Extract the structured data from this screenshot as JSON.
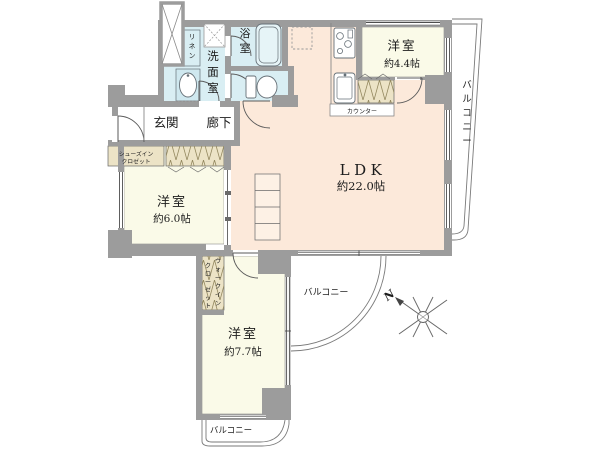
{
  "rooms": {
    "ldk": {
      "name": "LDK",
      "size": "約22.0帖"
    },
    "bedroom_44": {
      "name": "洋室",
      "size": "約4.4帖"
    },
    "bedroom_60": {
      "name": "洋室",
      "size": "約6.0帖"
    },
    "bedroom_77": {
      "name": "洋室",
      "size": "約7.7帖"
    },
    "bath": {
      "name": "浴室"
    },
    "washroom": {
      "name": "洗面室"
    },
    "linen": {
      "name": "リネン"
    },
    "entrance": {
      "name": "玄関"
    },
    "hallway": {
      "name": "廊下"
    },
    "shoes_closet": {
      "line1": "シューズイン",
      "line2": "クロゼット"
    },
    "walk_in_closet": {
      "col_right": "ウォークイン",
      "col_left": "クローゼット"
    },
    "kitchen_counter": {
      "name": "カウンター"
    }
  },
  "balconies": {
    "right": {
      "name": "バルコニー"
    },
    "middle": {
      "name": "バルコニー"
    },
    "bottom": {
      "name": "バルコニー"
    }
  },
  "compass": {
    "north_label": "N"
  },
  "colors": {
    "wall": "#9c9c9c",
    "ldk_floor": "#fce9da",
    "bedroom_floor": "#fafae8",
    "wet_floor": "#d9eef3",
    "closet": "#ece3c6",
    "balcony_line": "#7a7a7a"
  }
}
